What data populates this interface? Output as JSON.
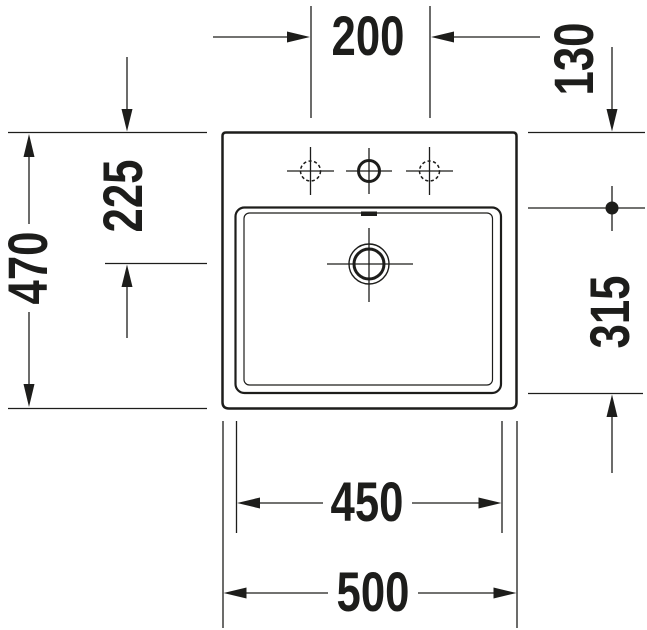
{
  "drawing": {
    "subject": "washbasin-top-view-technical-drawing",
    "colors": {
      "line": "#1d1d1b",
      "background": "#ffffff"
    },
    "dimensions": {
      "tap_hole_spacing": "200",
      "front_edge_to_rim": "130",
      "front_edge_to_drain": "225",
      "overall_depth": "470",
      "rim_to_basin_back": "315",
      "basin_width": "450",
      "overall_width": "500"
    }
  }
}
